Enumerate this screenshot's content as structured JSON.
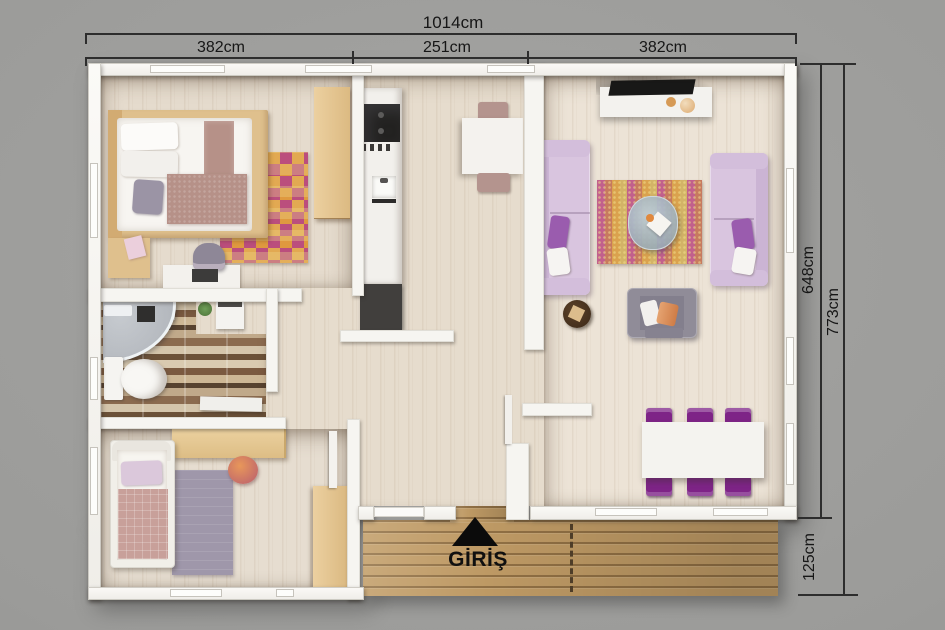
{
  "scene": {
    "type": "3d-floor-plan-top-view",
    "background_color": "#9b9b99",
    "entrance_side": "bottom"
  },
  "dims": {
    "top_total": "1014cm",
    "seg_left": "382cm",
    "seg_center": "251cm",
    "seg_right": "382cm",
    "right_inner": "648cm",
    "right_total": "773cm",
    "deck_depth": "125cm"
  },
  "entrance": {
    "label": "GİRİŞ",
    "marker": "black-triangle-up"
  },
  "rooms": {
    "top_left": "bedroom-double",
    "mid_left": "bathroom",
    "bottom_left": "bedroom-single",
    "center": "kitchen",
    "right": "living-room",
    "bottom_right": "dining-area",
    "bottom": "entrance-wood-deck"
  },
  "palette": {
    "wall": "#f6f5f1",
    "floor_wood": "#e6dccd",
    "floor_living": "#ece3d6",
    "deck_wood": "#c19c66",
    "sofa_lilac": "#d9c5df",
    "pillow_purple": "#9a5cae",
    "dining_chair_purple": "#7e2487",
    "kitchen_chair_mauve": "#b4948e",
    "rug_checker_orange": "#df993f",
    "rug_checker_magenta": "#bb4e7d",
    "rug_living_pink": "#c2608c",
    "rug_living_gold": "#daa24e",
    "rug_bedroom2_gray": "#9f97aa",
    "appliance_black": "#232221",
    "furniture_wood": "#e0c28d",
    "dimension_line": "#2d2d2d"
  }
}
